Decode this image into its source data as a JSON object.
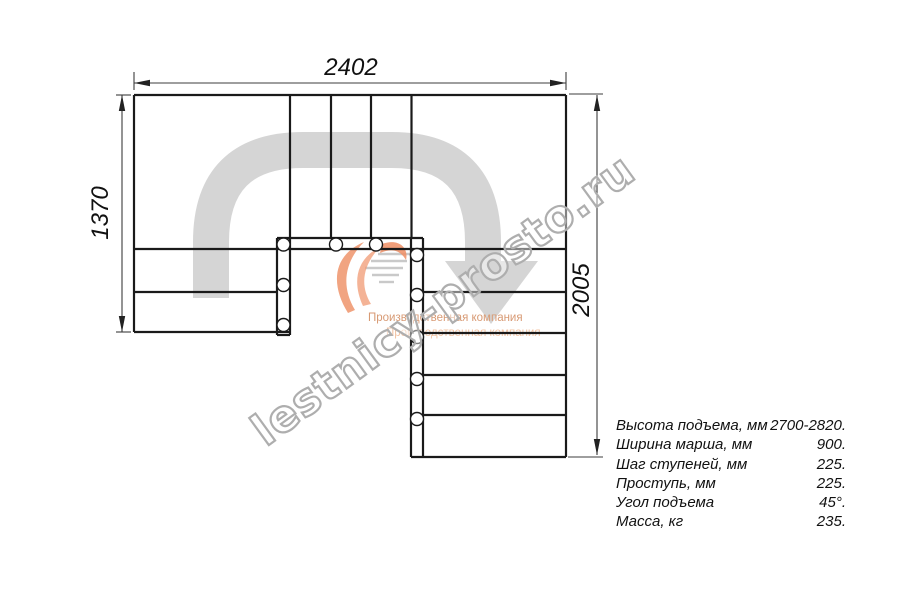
{
  "drawing": {
    "title_role": "staircase-plan-view",
    "dim_top": "2402",
    "dim_left": "1370",
    "dim_right": "2005"
  },
  "watermark": {
    "site": "lestnicy-prosto.ru",
    "tagline_primary": "Производственная компания",
    "tagline_secondary": "Производственная компания"
  },
  "specs": {
    "rows": [
      {
        "label": "Высота подъема, мм",
        "value": "2700-2820."
      },
      {
        "label": "Ширина марша, мм",
        "value": "900."
      },
      {
        "label": "Шаг ступеней, мм",
        "value": "225."
      },
      {
        "label": "Проступь, мм",
        "value": "225."
      },
      {
        "label": "Угол подъема",
        "value": "45°."
      },
      {
        "label": "Масса, кг",
        "value": "235."
      }
    ]
  },
  "colors": {
    "line": "#1a1a1a",
    "dimension_line": "#3d3d3d",
    "route_grey": "#d5d5d5",
    "logo_orange": "#f09a73",
    "watermark_grey": "#aeaeae"
  }
}
